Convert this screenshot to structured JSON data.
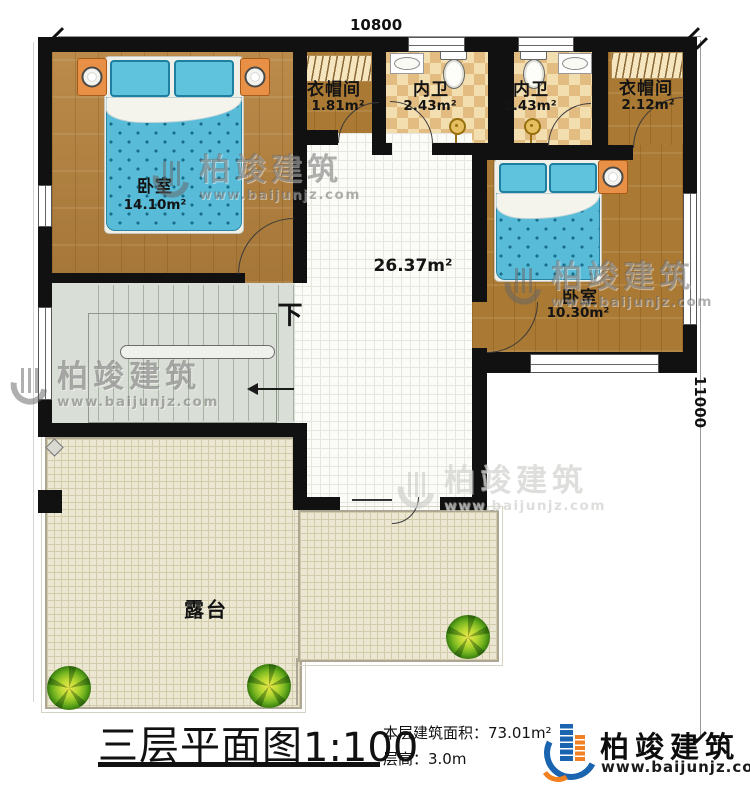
{
  "dimensions": {
    "width_label": "10800",
    "height_label": "11000"
  },
  "rooms": {
    "bedroom_left": {
      "name": "卧室",
      "area": "14.10m²"
    },
    "cloakroom_left": {
      "name": "衣帽间",
      "area": "1.81m²"
    },
    "bathroom_left": {
      "name": "内卫",
      "area": "2.43m²"
    },
    "bathroom_right": {
      "name": "内卫",
      "area": "2.43m²"
    },
    "cloakroom_right": {
      "name": "衣帽间",
      "area": "2.12m²"
    },
    "bedroom_right": {
      "name": "卧室",
      "area": "10.30m²"
    },
    "hall": {
      "area": "26.37m²"
    },
    "terrace": {
      "name": "露台"
    },
    "stairs": {
      "direction_label": "下"
    }
  },
  "title_block": {
    "title": "三层平面图",
    "scale": "1:100",
    "floor_area_label": "本层建筑面积：73.01m²",
    "floor_height_label": "层高：3.0m"
  },
  "brand": {
    "name": "柏竣建筑",
    "website": "www.baijunjz.com"
  },
  "watermark": {
    "name": "柏竣建筑",
    "website": "www.baijunjz.com"
  }
}
